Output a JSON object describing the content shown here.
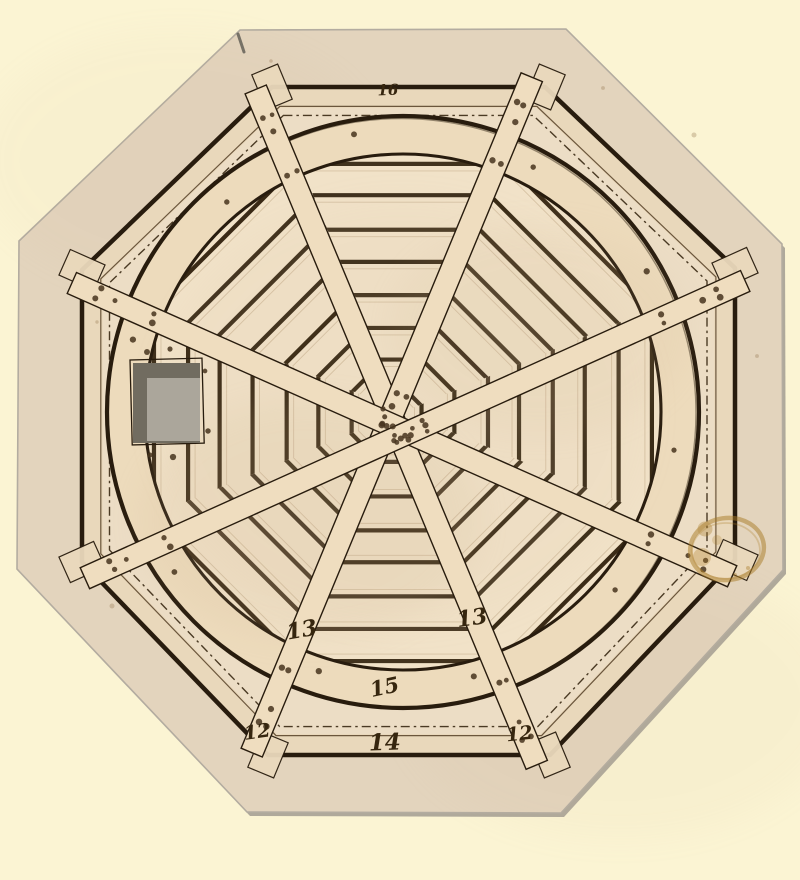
{
  "artwork": {
    "colors": {
      "background": "#FBF4D3",
      "paper": "#E3D4BD",
      "paper_edge": "#B3ACA0",
      "paper_shadow": "#A19B90",
      "interior": "#ECDDC5",
      "beam": "#E9D8BB",
      "ring_band": "#EDDBBC",
      "disc": "#F1E2C8",
      "plank_gap": "#32230F",
      "plank_edge": "#B59C79",
      "brace_fill": "#EFDDBF",
      "pad_fill": "#EAD9BC",
      "ink": "#281C0E",
      "thin_line": "#6B563C",
      "dash_line": "#4A3A24",
      "dot": "#46341D",
      "hatch_outer": "#716C60",
      "hatch_inner": "#ABA69B",
      "stain": "#A87A25",
      "script_ink": "#36260F",
      "wash": "#C9AE8C",
      "pencil": "#5D5A52",
      "foxing": "#8A6B42"
    },
    "geometry": {
      "canvas": {
        "w": 800,
        "h": 880
      },
      "paper_octagon": [
        [
          240,
          30
        ],
        [
          566,
          29
        ],
        [
          782,
          244
        ],
        [
          783,
          570
        ],
        [
          561,
          813
        ],
        [
          247,
          812
        ],
        [
          17,
          569
        ],
        [
          19,
          241
        ]
      ],
      "ink_octagon": [
        [
          272,
          87
        ],
        [
          545,
          87
        ],
        [
          735,
          268
        ],
        [
          735,
          560
        ],
        [
          550,
          755
        ],
        [
          268,
          755
        ],
        [
          82,
          562
        ],
        [
          82,
          270
        ]
      ],
      "frame_center": [
        406,
        421
      ],
      "frame_scales": {
        "beam": 0.967,
        "thin": 0.942,
        "dash": 0.915
      },
      "ring": {
        "cx": 403,
        "cy": 412,
        "r_outer": 296,
        "r_inner": 258
      },
      "planks": {
        "r_clip": 257,
        "start": 18,
        "spacing": 33,
        "gap_width": 4.2
      },
      "braces": [
        {
          "from": [
            272,
            87
          ],
          "to": [
            550,
            755
          ]
        },
        {
          "from": [
            545,
            87
          ],
          "to": [
            268,
            755
          ]
        },
        {
          "from": [
            82,
            270
          ],
          "to": [
            735,
            560
          ]
        },
        {
          "from": [
            82,
            562
          ],
          "to": [
            735,
            268
          ]
        }
      ],
      "brace_width": 23,
      "weave_offset": 16,
      "pad_size": [
        38,
        28
      ],
      "hatch": {
        "outline": [
          130,
          360,
          72,
          85
        ],
        "outer": [
          133,
          363,
          67,
          80
        ],
        "inner": [
          147,
          378,
          53,
          63
        ]
      },
      "hatch_dots": [
        [
          147,
          352
        ],
        [
          170,
          349
        ],
        [
          205,
          371
        ],
        [
          208,
          431
        ],
        [
          150,
          455
        ],
        [
          173,
          457
        ]
      ],
      "ring_dot_angles": [
        -100,
        -62,
        -30,
        8,
        40,
        75,
        108,
        145,
        195,
        230
      ],
      "stain": {
        "cx": 727,
        "cy": 549,
        "rx": 37,
        "ry": 31
      },
      "washes": [
        [
          310,
          520,
          170,
          120,
          0.12
        ],
        [
          540,
          330,
          150,
          105,
          0.09
        ],
        [
          403,
          412,
          250,
          215,
          0.06
        ]
      ],
      "paper_washes": [
        [
          620,
          700,
          220,
          140,
          0.06
        ],
        [
          180,
          160,
          200,
          130,
          0.05
        ]
      ],
      "foxing": [
        [
          271,
          61
        ],
        [
          603,
          88
        ],
        [
          97,
          322
        ],
        [
          757,
          356
        ],
        [
          694,
          135
        ],
        [
          112,
          606
        ]
      ],
      "pencil_tick": [
        [
          238,
          34
        ],
        [
          244,
          52
        ]
      ]
    },
    "annotations": [
      {
        "text": "16",
        "x": 388,
        "y": 95,
        "size": 15,
        "rot": -2
      },
      {
        "text": "13",
        "x": 303,
        "y": 637,
        "size": 22,
        "rot": -10
      },
      {
        "text": "13",
        "x": 473,
        "y": 625,
        "size": 22,
        "rot": -8
      },
      {
        "text": "15",
        "x": 386,
        "y": 694,
        "size": 21,
        "rot": -12
      },
      {
        "text": "14",
        "x": 385,
        "y": 750,
        "size": 23,
        "rot": -2
      },
      {
        "text": "12",
        "x": 258,
        "y": 738,
        "size": 19,
        "rot": -8
      },
      {
        "text": "12",
        "x": 520,
        "y": 740,
        "size": 19,
        "rot": -6
      }
    ]
  }
}
